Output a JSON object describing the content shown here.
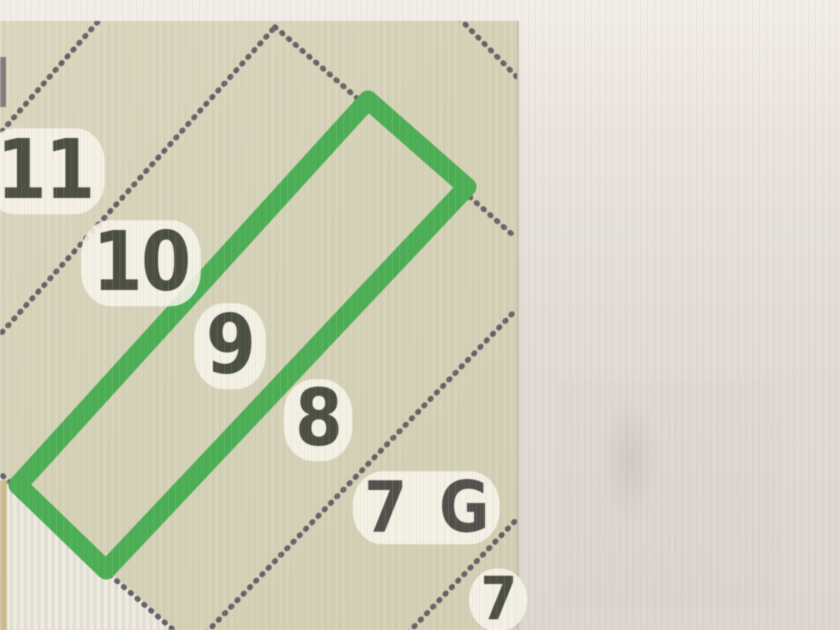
{
  "map": {
    "lot_labels": [
      {
        "id": "lot-11",
        "text": "11"
      },
      {
        "id": "lot-10",
        "text": "10"
      },
      {
        "id": "lot-9",
        "text": "9"
      },
      {
        "id": "lot-8",
        "text": "8"
      },
      {
        "id": "lot-7g",
        "text": "7 G"
      },
      {
        "id": "lot-7",
        "text": "7"
      }
    ],
    "highlighted_lot": "9",
    "colors": {
      "highlight_green": "#4bae54",
      "boundary_line": "#56515c",
      "map_background": "#d6d2b8",
      "label_text": "#4b4e42",
      "label_halo": "#f6f3ea",
      "margin_white": "#eae6dc",
      "sheet_edge_tan": "#c9b98a",
      "photo_background": "#ded8d2"
    }
  }
}
